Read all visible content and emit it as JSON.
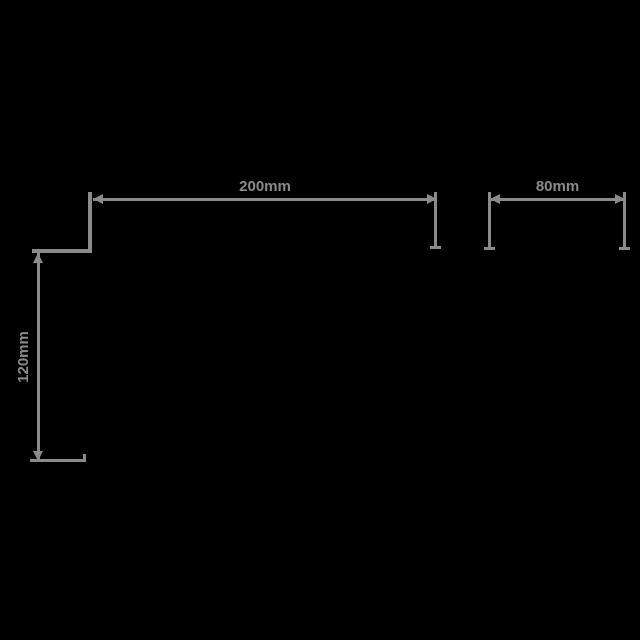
{
  "canvas": {
    "background": "#000000",
    "line_color": "#8a8a8a",
    "unit": "mm"
  },
  "dimensions": {
    "top_width": {
      "label": "200mm",
      "value": 200
    },
    "left_height": {
      "label": "120mm",
      "value": 120
    },
    "right_width": {
      "label": "80mm",
      "value": 80
    }
  }
}
